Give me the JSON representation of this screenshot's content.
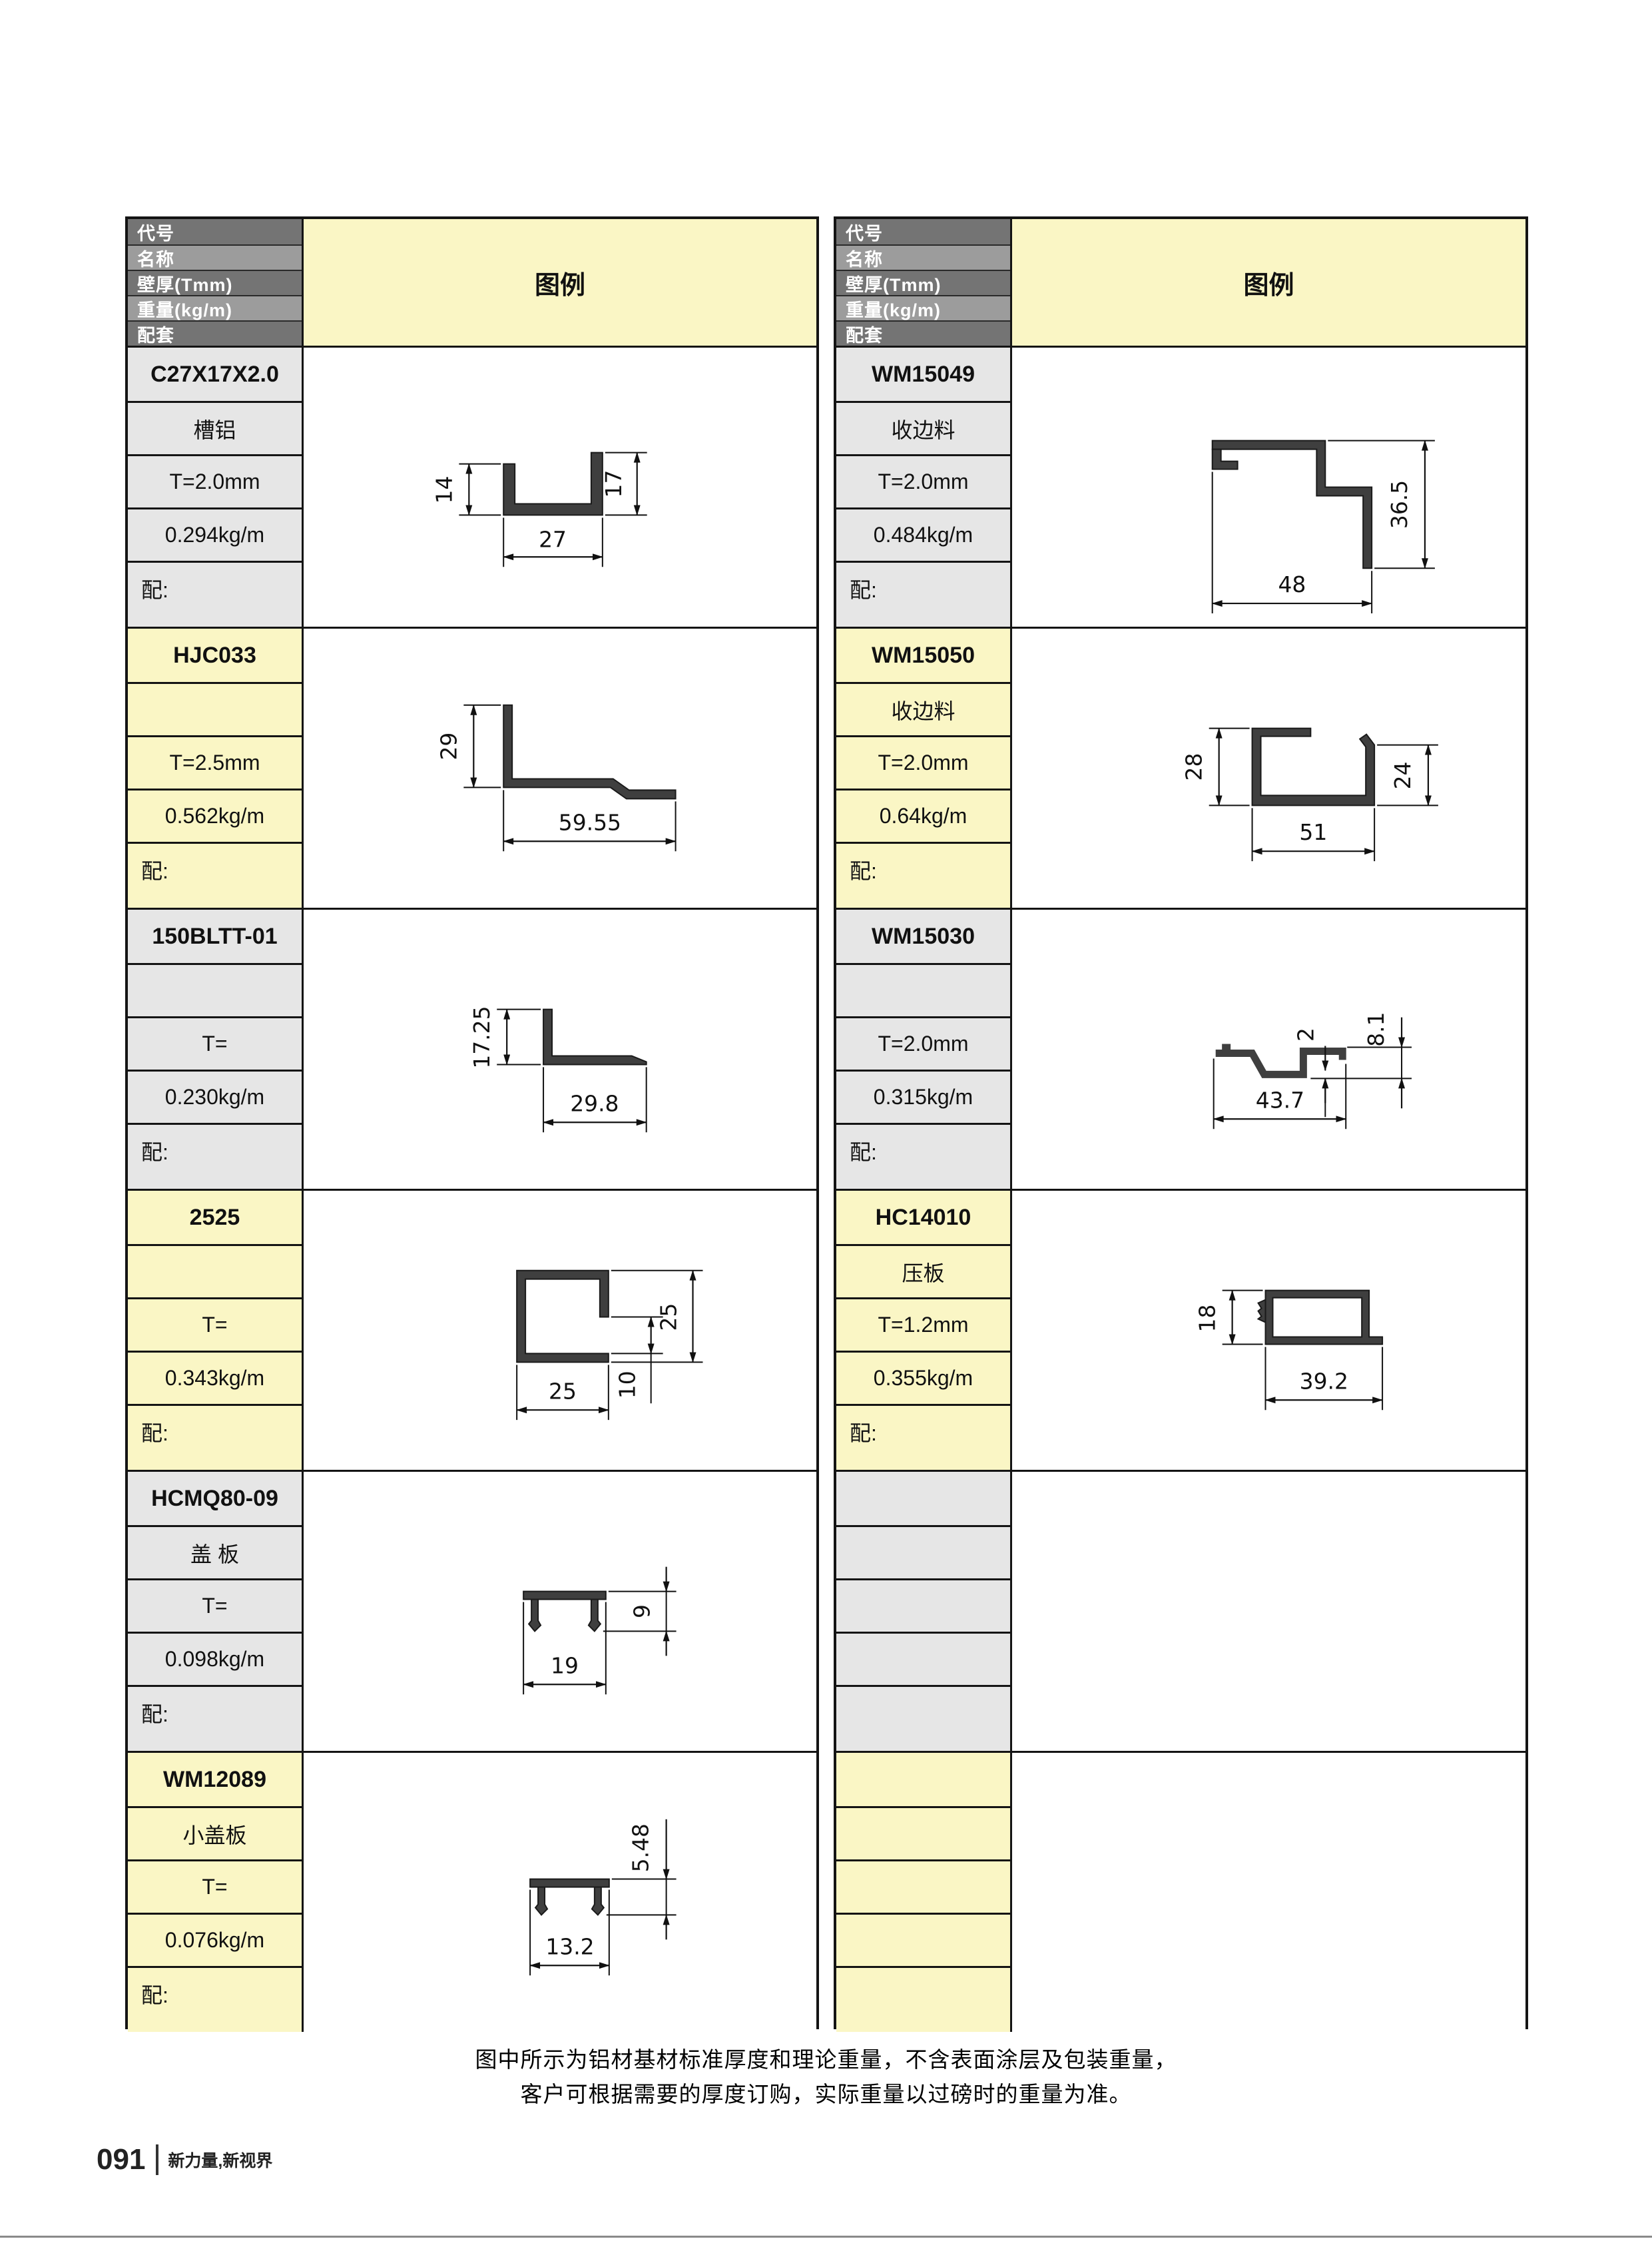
{
  "theme": {
    "accent_yellow": "#FAF6C5",
    "row_gray": "#E6E6E6",
    "header_dark": "#747474",
    "header_light": "#9C9C9C",
    "border_black": "#141414",
    "profile_fill": "#3F3F3F"
  },
  "legend_title": "图例",
  "header_labels": {
    "code": "代号",
    "name": "名称",
    "thickness": "壁厚(Tmm)",
    "weight": "重量(kg/m)",
    "accessory": "配套"
  },
  "left_table": {
    "groups": [
      {
        "code": "C27X17X2.0",
        "name": "槽铝",
        "thickness": "T=2.0mm",
        "weight": "0.294kg/m",
        "accessory": "配:",
        "dims": {
          "left_height": "14",
          "right_height": "17",
          "width": "27"
        }
      },
      {
        "code": "HJC033",
        "name": "",
        "thickness": "T=2.5mm",
        "weight": "0.562kg/m",
        "accessory": "配:",
        "dims": {
          "height": "29",
          "width": "59.55"
        }
      },
      {
        "code": "150BLTT-01",
        "name": "",
        "thickness": "T=",
        "weight": "0.230kg/m",
        "accessory": "配:",
        "dims": {
          "height": "17.25",
          "width": "29.8"
        }
      },
      {
        "code": "2525",
        "name": "",
        "thickness": "T=",
        "weight": "0.343kg/m",
        "accessory": "配:",
        "dims": {
          "height": "25",
          "gap": "10",
          "width": "25"
        }
      },
      {
        "code": "HCMQ80-09",
        "name": "盖 板",
        "thickness": "T=",
        "weight": "0.098kg/m",
        "accessory": "配:",
        "dims": {
          "height": "9",
          "width": "19"
        }
      },
      {
        "code": "WM12089",
        "name": "小盖板",
        "thickness": "T=",
        "weight": "0.076kg/m",
        "accessory": "配:",
        "dims": {
          "height": "5.48",
          "width": "13.2"
        }
      }
    ]
  },
  "right_table": {
    "groups": [
      {
        "code": "WM15049",
        "name": "收边料",
        "thickness": "T=2.0mm",
        "weight": "0.484kg/m",
        "accessory": "配:",
        "dims": {
          "height": "36.5",
          "width": "48"
        }
      },
      {
        "code": "WM15050",
        "name": "收边料",
        "thickness": "T=2.0mm",
        "weight": "0.64kg/m",
        "accessory": "配:",
        "dims": {
          "left_height": "28",
          "right_height": "24",
          "width": "51"
        }
      },
      {
        "code": "WM15030",
        "name": "",
        "thickness": "T=2.0mm",
        "weight": "0.315kg/m",
        "accessory": "配:",
        "dims": {
          "thickness": "2",
          "height": "8.1",
          "width": "43.7"
        }
      },
      {
        "code": "HC14010",
        "name": "压板",
        "thickness": "T=1.2mm",
        "weight": "0.355kg/m",
        "accessory": "配:",
        "dims": {
          "height": "18",
          "width": "39.2"
        }
      },
      {
        "code": "",
        "name": "",
        "thickness": "",
        "weight": "",
        "accessory": "",
        "dims": {}
      },
      {
        "code": "",
        "name": "",
        "thickness": "",
        "weight": "",
        "accessory": "",
        "dims": {}
      }
    ]
  },
  "footer": {
    "note_line1": "图中所示为铝材基材标准厚度和理论重量，不含表面涂层及包装重量，",
    "note_line2": "客户可根据需要的厚度订购，实际重量以过磅时的重量为准。",
    "page_number": "091",
    "tagline": "新力量,新视界"
  }
}
